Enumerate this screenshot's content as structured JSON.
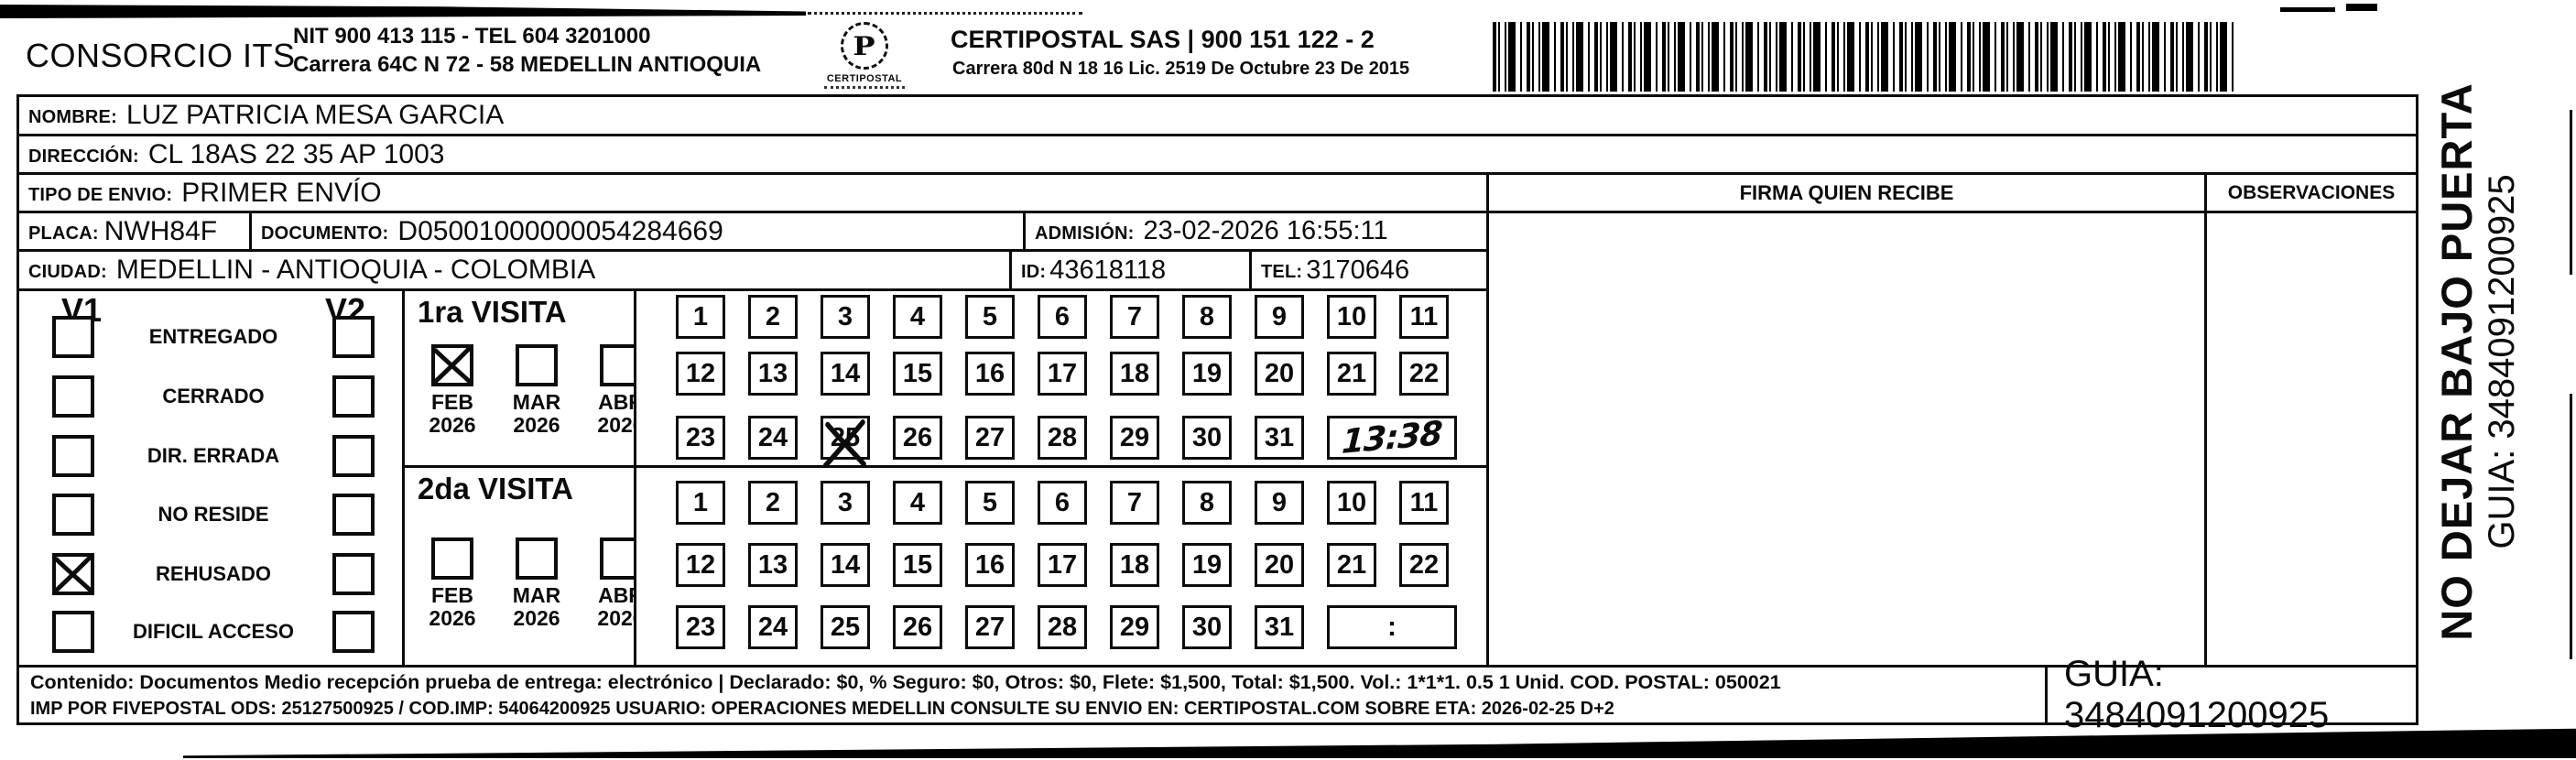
{
  "header": {
    "company": "CONSORCIO ITS",
    "nit_line": "NIT 900 413 115 - TEL 604 3201000",
    "address_line": "Carrera 64C N 72 - 58 MEDELLIN ANTIOQUIA",
    "logo_glyph": "P",
    "logo_text": "CERTIPOSTAL",
    "provider_line": "CERTIPOSTAL SAS | 900 151 122 - 2",
    "provider_address": "Carrera 80d N 18 16  Lic. 2519 De Octubre 23 De 2015"
  },
  "fields": {
    "nombre": {
      "label": "NOMBRE:",
      "value": "LUZ PATRICIA MESA GARCIA"
    },
    "direccion": {
      "label": "DIRECCIÓN:",
      "value": "CL 18AS 22 35 AP 1003"
    },
    "tipo_envio": {
      "label": "TIPO DE ENVIO:",
      "value": "PRIMER ENVÍO"
    },
    "placa": {
      "label": "PLACA:",
      "value": "NWH84F"
    },
    "documento": {
      "label": "DOCUMENTO:",
      "value": "D05001000000054284669"
    },
    "admision": {
      "label": "ADMISIÓN:",
      "value": "23-02-2026 16:55:11"
    },
    "ciudad": {
      "label": "CIUDAD:",
      "value": "MEDELLIN - ANTIOQUIA - COLOMBIA"
    },
    "id": {
      "label": "ID:",
      "value": "43618118"
    },
    "tel": {
      "label": "TEL:",
      "value": "3170646"
    }
  },
  "status_panel": {
    "col1_header": "V1",
    "col2_header": "V2",
    "options": [
      {
        "label": "ENTREGADO",
        "v1_checked": false,
        "v2_checked": false
      },
      {
        "label": "CERRADO",
        "v1_checked": false,
        "v2_checked": false
      },
      {
        "label": "DIR. ERRADA",
        "v1_checked": false,
        "v2_checked": false
      },
      {
        "label": "NO RESIDE",
        "v1_checked": false,
        "v2_checked": false
      },
      {
        "label": "REHUSADO",
        "v1_checked": true,
        "v2_checked": false
      },
      {
        "label": "DIFICIL ACCESO",
        "v1_checked": false,
        "v2_checked": false
      }
    ]
  },
  "visits": [
    {
      "title": "1ra VISITA",
      "months": [
        {
          "month": "FEB",
          "year": "2026",
          "checked": true
        },
        {
          "month": "MAR",
          "year": "2026",
          "checked": false
        },
        {
          "month": "ABR",
          "year": "2026",
          "checked": false
        }
      ],
      "crossed_day": 25,
      "time_box": {
        "handwritten": true,
        "value": "13:38"
      }
    },
    {
      "title": "2da VISITA",
      "months": [
        {
          "month": "FEB",
          "year": "2026",
          "checked": false
        },
        {
          "month": "MAR",
          "year": "2026",
          "checked": false
        },
        {
          "month": "ABR",
          "year": "2026",
          "checked": false
        }
      ],
      "crossed_day": null,
      "time_box": {
        "handwritten": false,
        "value": ":"
      }
    }
  ],
  "days": [
    1,
    2,
    3,
    4,
    5,
    6,
    7,
    8,
    9,
    10,
    11,
    12,
    13,
    14,
    15,
    16,
    17,
    18,
    19,
    20,
    21,
    22,
    23,
    24,
    25,
    26,
    27,
    28,
    29,
    30,
    31
  ],
  "table_headers": {
    "firma": "FIRMA QUIEN RECIBE",
    "observaciones": "OBSERVACIONES"
  },
  "side_note": {
    "line1": "NO DEJAR BAJO PUERTA",
    "line2": "GUIA: 3484091200925"
  },
  "footer": {
    "line1": "Contenido: Documentos Medio recepción prueba de entrega: electrónico | Declarado: $0, % Seguro: $0, Otros: $0, Flete: $1,500, Total: $1,500. Vol.: 1*1*1. 0.5  1 Unid. COD. POSTAL: 050021",
    "line2": "IMP POR FIVEPOSTAL ODS: 25127500925 / COD.IMP: 54064200925 USUARIO: OPERACIONES MEDELLIN CONSULTE SU ENVIO EN: CERTIPOSTAL.COM SOBRE ETA: 2026-02-25 D+2",
    "guia": "GUIA: 3484091200925"
  }
}
